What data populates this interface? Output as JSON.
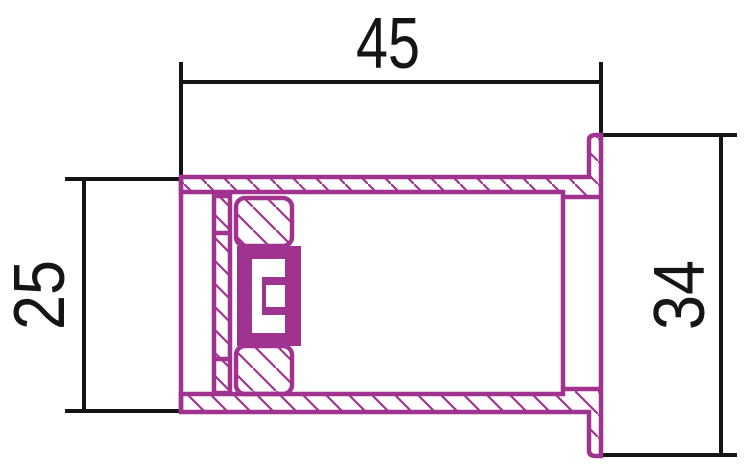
{
  "drawing": {
    "description": "Technical cross-section drawing of a flanged bushing with internal seal and insert assembly",
    "dimensions": {
      "overall_length": {
        "label": "45",
        "orientation": "horizontal",
        "position": "top"
      },
      "body_outer_height": {
        "label": "25",
        "orientation": "vertical",
        "position": "left"
      },
      "flange_outer_height": {
        "label": "34",
        "orientation": "vertical",
        "position": "right"
      }
    },
    "colors": {
      "part": "#a0338f",
      "dimension": "#151515",
      "background": "#ffffff"
    }
  }
}
